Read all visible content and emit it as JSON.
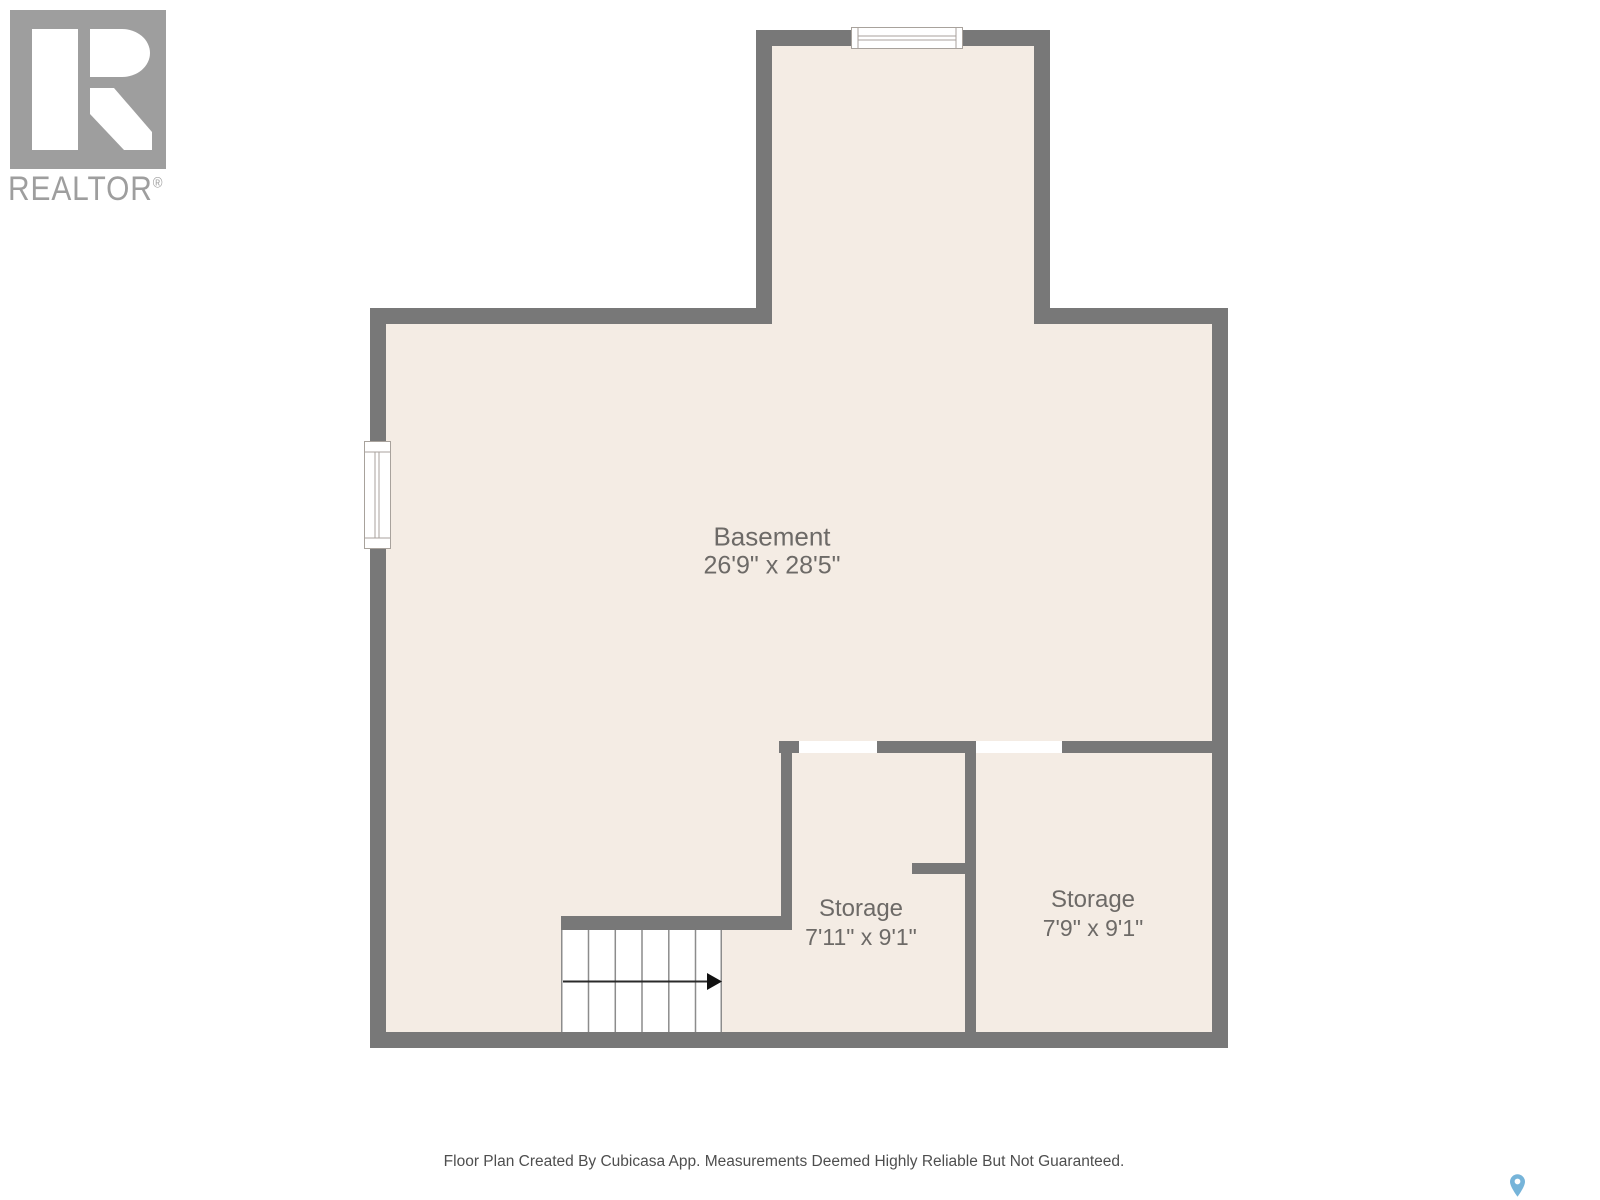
{
  "branding": {
    "logo_text": "REALTOR",
    "registered_mark": "®"
  },
  "floor_plan": {
    "rooms": [
      {
        "name": "Basement",
        "dimensions": "26'9\" x 28'5\""
      },
      {
        "name": "Storage",
        "dimensions": "7'11\" x 9'1\""
      },
      {
        "name": "Storage",
        "dimensions": "7'9\" x 9'1\""
      }
    ],
    "stairs": {
      "steps": 6,
      "direction_arrow": "right"
    }
  },
  "footer": {
    "disclaimer": "Floor Plan Created By Cubicasa App. Measurements Deemed Highly Reliable But Not Guaranteed."
  },
  "colors": {
    "wall": "#787878",
    "floor": "#f4ece4",
    "room_label": "#6d6a67",
    "disclaimer_text": "#4e4e4e",
    "logo_gray": "#9e9e9e",
    "map_pin": "#76b4d9"
  }
}
